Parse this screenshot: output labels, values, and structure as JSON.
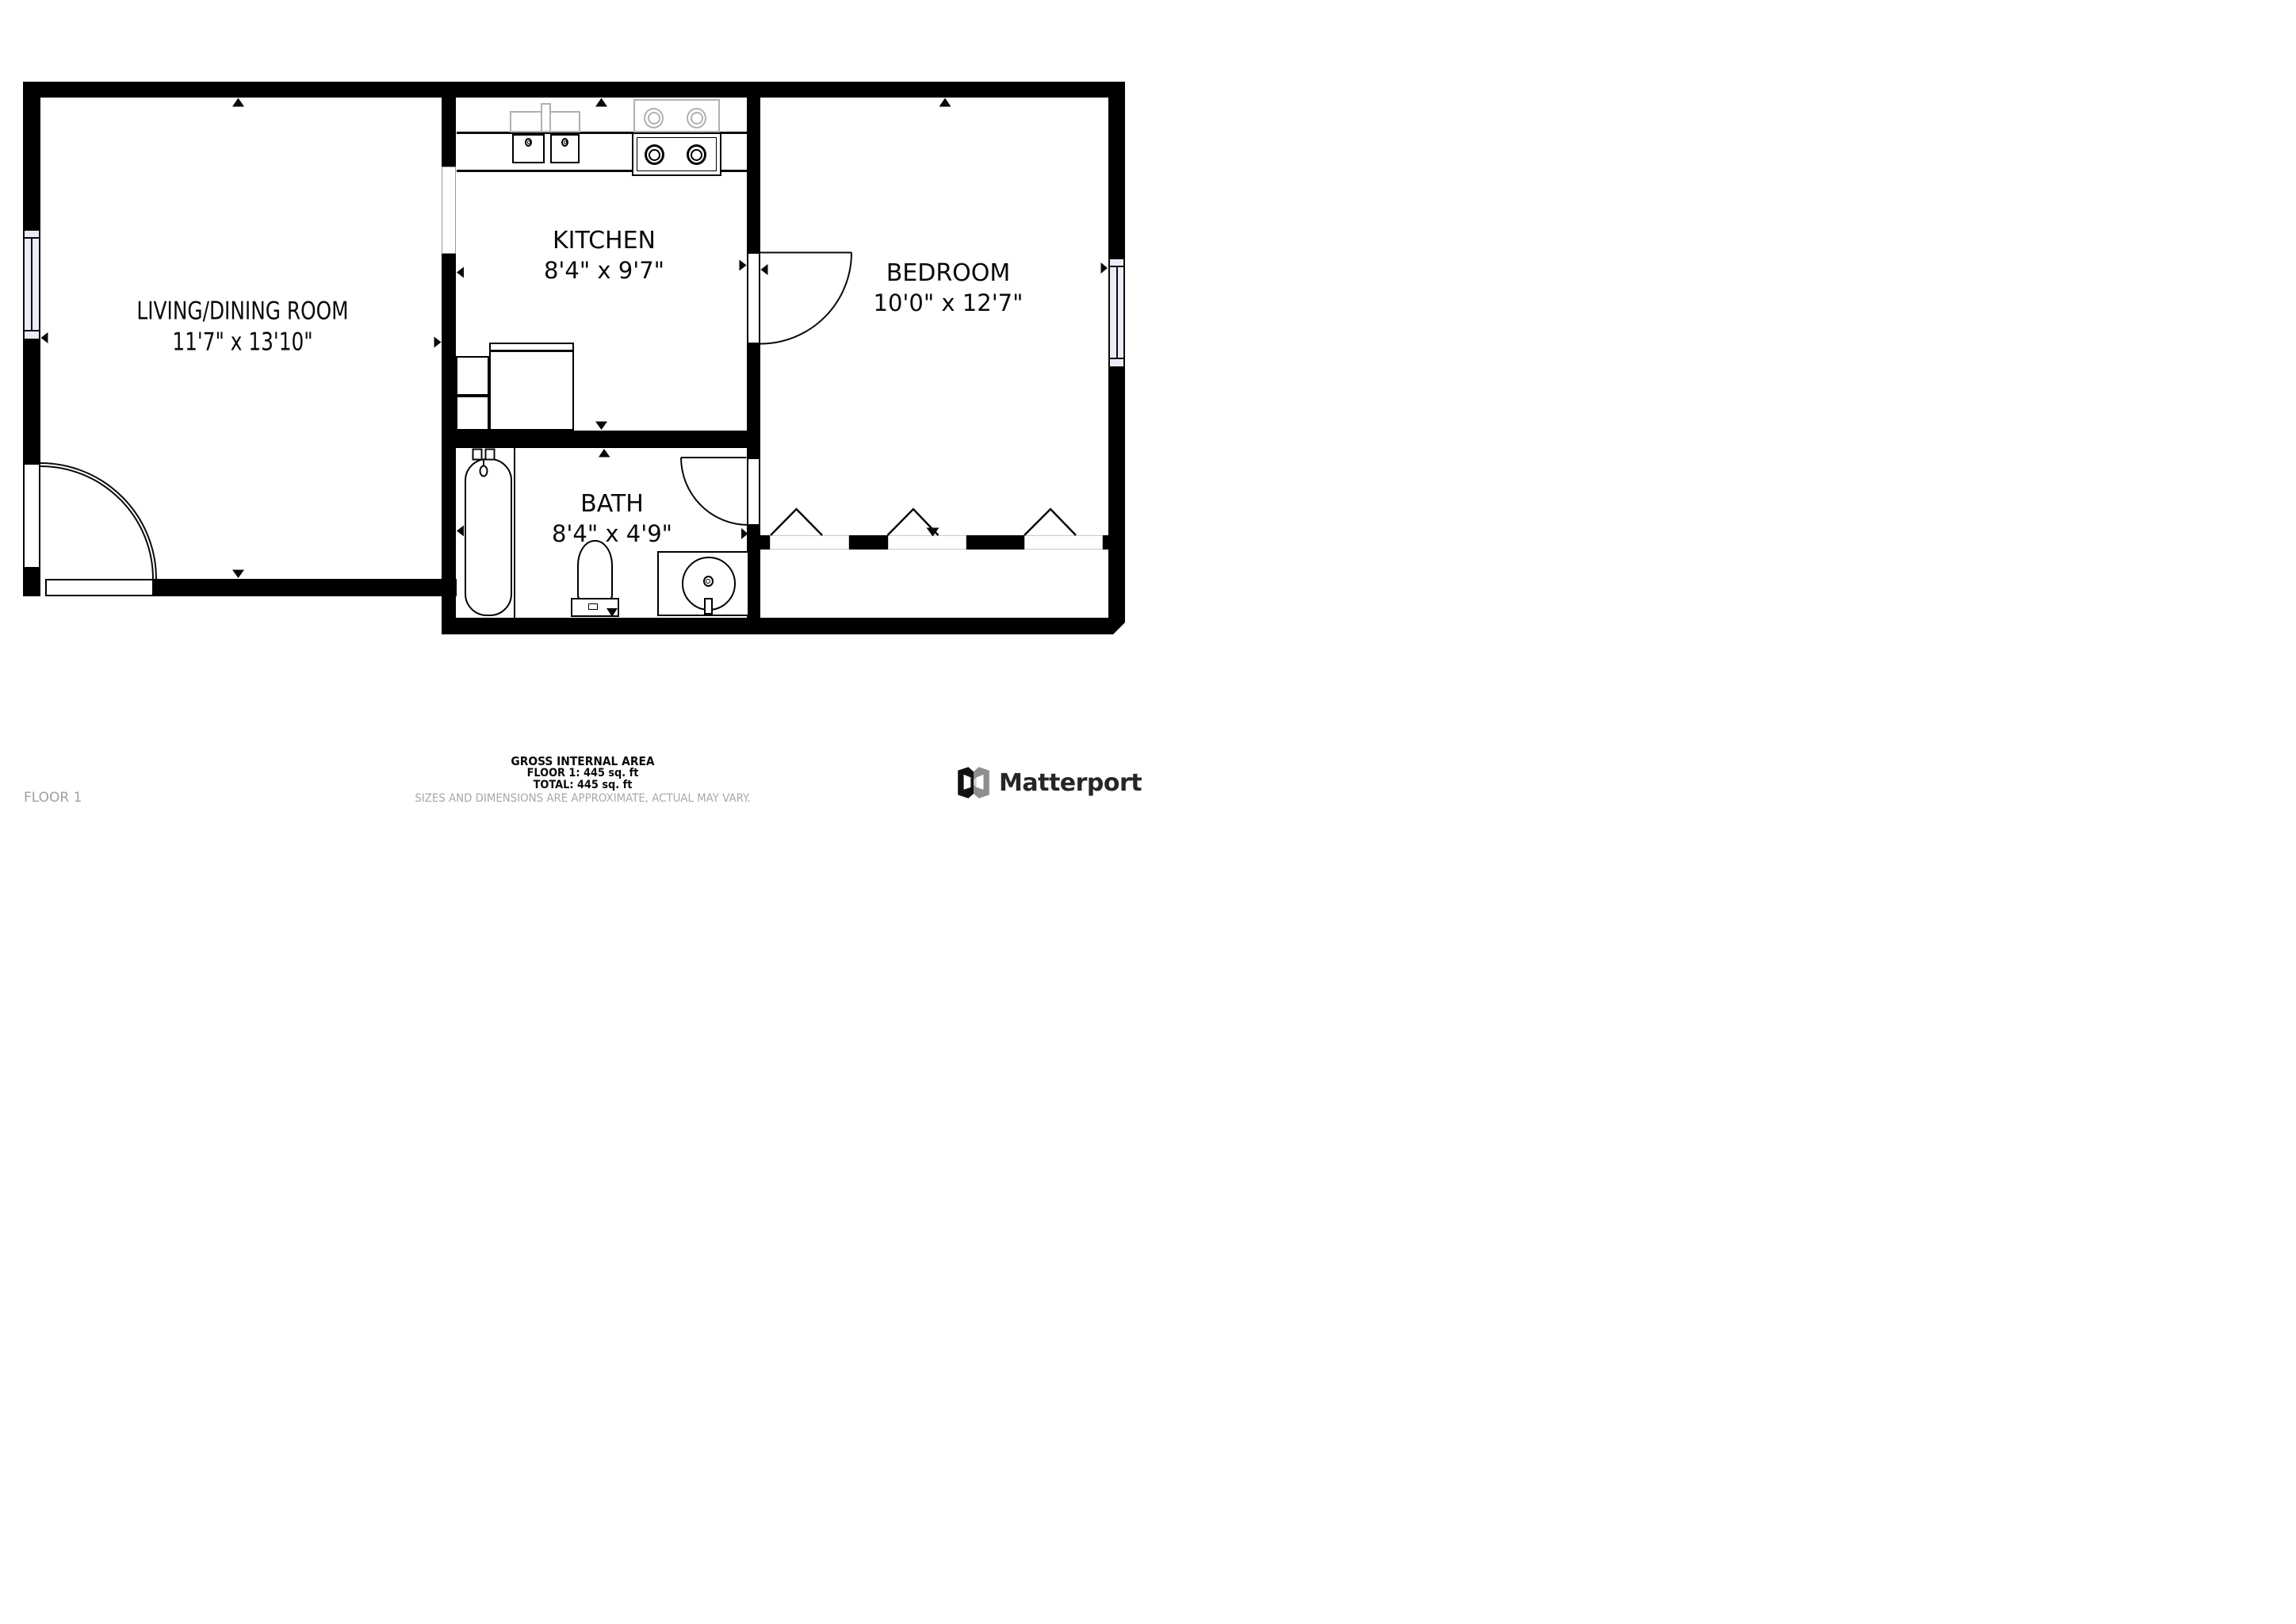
{
  "floorplan": {
    "rooms": [
      {
        "name": "LIVING/DINING ROOM",
        "dimensions": "11'7\" x 13'10\""
      },
      {
        "name": "KITCHEN",
        "dimensions": "8'4\" x 9'7\""
      },
      {
        "name": "BEDROOM",
        "dimensions": "10'0\" x 12'7\""
      },
      {
        "name": "BATH",
        "dimensions": "8'4\" x 4'9\""
      }
    ],
    "fixtures": [
      "kitchen-sink",
      "stove",
      "refrigerator",
      "kitchen-counters",
      "bathtub",
      "toilet",
      "vanity-sink",
      "entry-door",
      "bedroom-door",
      "bath-door",
      "window-left",
      "window-right",
      "closet-bifold-doors",
      "pass-through"
    ],
    "colors": {
      "wall": "#000000",
      "window_fill": "#ececf8",
      "fixture_gray": "#b0b0b0",
      "muted_text": "#a8a8a8",
      "brand_text": "#262626"
    }
  },
  "footer": {
    "area_title": "GROSS INTERNAL AREA",
    "area_floor": "FLOOR 1: 445 sq. ft",
    "area_total": "TOTAL: 445 sq. ft",
    "disclaimer": "SIZES AND DIMENSIONS ARE APPROXIMATE, ACTUAL MAY VARY.",
    "floor_label": "FLOOR 1",
    "brand": "Matterport"
  }
}
